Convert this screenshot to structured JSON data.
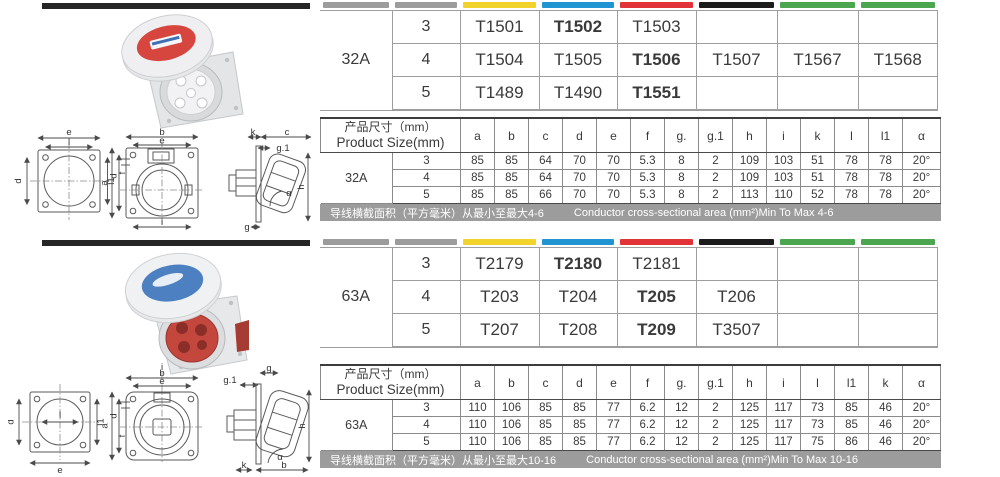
{
  "colors": {
    "divider_bar": "#262626",
    "strip_gray": "#9C9C9C",
    "strip_yellow": "#F2D32B",
    "strip_blue": "#2095D2",
    "strip_red": "#E23438",
    "strip_black": "#1C1C1C",
    "strip_green": "#4CA64F",
    "note_bar_bg": "#9C9C9C",
    "photo_top_cap": "#D7463E",
    "photo_bottom_cap": "#4C80C1",
    "photo_bottom_face": "#C4473E"
  },
  "sections": [
    {
      "rating": "32A",
      "model_table": {
        "strip_colors": [
          "#9C9C9C",
          "#9C9C9C",
          "#F2D32B",
          "#2095D2",
          "#E23438",
          "#1C1C1C",
          "#4CA64F",
          "#4CA64F"
        ],
        "rows": [
          {
            "poles": "3",
            "models": [
              "T1501",
              "T1502",
              "T1503",
              "",
              "",
              ""
            ]
          },
          {
            "poles": "4",
            "models": [
              "T1504",
              "T1505",
              "T1506",
              "T1507",
              "T1567",
              "T1568"
            ]
          },
          {
            "poles": "5",
            "models": [
              "T1489",
              "T1490",
              "T1551",
              "",
              "",
              ""
            ]
          }
        ]
      },
      "size_table": {
        "title_cn": "产品尺寸（mm）",
        "title_en": "Product Size(mm)",
        "columns": [
          "a",
          "b",
          "c",
          "d",
          "e",
          "f",
          "g.",
          "g.1",
          "h",
          "i",
          "k",
          "l",
          "l1",
          "α"
        ],
        "rows": [
          {
            "poles": "3",
            "values": [
              "85",
              "85",
              "64",
              "70",
              "70",
              "5.3",
              "8",
              "2",
              "109",
              "103",
              "51",
              "78",
              "78",
              "20°"
            ]
          },
          {
            "poles": "4",
            "values": [
              "85",
              "85",
              "64",
              "70",
              "70",
              "5.3",
              "8",
              "2",
              "109",
              "103",
              "51",
              "78",
              "78",
              "20°"
            ]
          },
          {
            "poles": "5",
            "values": [
              "85",
              "85",
              "66",
              "70",
              "70",
              "5.3",
              "8",
              "2",
              "113",
              "110",
              "52",
              "78",
              "78",
              "20°"
            ]
          }
        ]
      },
      "note_cn": "导线横截面积（平方毫米）从最小至最大4-6",
      "note_en": "Conductor cross-sectional area (mm²)Min To Max 4-6"
    },
    {
      "rating": "63A",
      "model_table": {
        "strip_colors": [
          "#9C9C9C",
          "#9C9C9C",
          "#F2D32B",
          "#2095D2",
          "#E23438",
          "#1C1C1C",
          "#4CA64F",
          "#4CA64F"
        ],
        "rows": [
          {
            "poles": "3",
            "models": [
              "T2179",
              "T2180",
              "T2181",
              "",
              "",
              ""
            ]
          },
          {
            "poles": "4",
            "models": [
              "T203",
              "T204",
              "T205",
              "T206",
              "",
              ""
            ]
          },
          {
            "poles": "5",
            "models": [
              "T207",
              "T208",
              "T209",
              "T3507",
              "",
              ""
            ]
          }
        ]
      },
      "size_table": {
        "title_cn": "产品尺寸（mm）",
        "title_en": "Product Size(mm)",
        "columns": [
          "a",
          "b",
          "c",
          "d",
          "e",
          "f",
          "g.",
          "g.1",
          "h",
          "i",
          "l",
          "l1",
          "k",
          "α"
        ],
        "rows": [
          {
            "poles": "3",
            "values": [
              "110",
              "106",
              "85",
              "85",
              "77",
              "6.2",
              "12",
              "2",
              "125",
              "117",
              "73",
              "85",
              "46",
              "20°"
            ]
          },
          {
            "poles": "4",
            "values": [
              "110",
              "106",
              "85",
              "85",
              "77",
              "6.2",
              "12",
              "2",
              "125",
              "117",
              "73",
              "85",
              "46",
              "20°"
            ]
          },
          {
            "poles": "5",
            "values": [
              "110",
              "106",
              "85",
              "85",
              "77",
              "6.2",
              "12",
              "2",
              "125",
              "117",
              "75",
              "86",
              "46",
              "20°"
            ]
          }
        ]
      },
      "note_cn": "导线横截面积（平方毫米）从最小至最大10-16",
      "note_en": "Conductor cross-sectional area (mm²)Min To Max 10-16"
    }
  ],
  "drawings": {
    "top": {
      "view1": {
        "top_outer": "e",
        "top_inner": "l",
        "left": "d",
        "right": "l1"
      },
      "view2": {
        "top_outer": "b",
        "top_inner": "e",
        "left_outer": "a",
        "left_inner": "d",
        "small": "f",
        "bottom": "i"
      },
      "view3": {
        "top_left": "k",
        "top_right": "c",
        "g1": "g.1",
        "right": "h",
        "angle": "α",
        "bottom": "g"
      }
    },
    "bottom": {
      "view1": {
        "left": "d",
        "center": "l",
        "right": "l1",
        "bottom": "e"
      },
      "view2": {
        "top_center": "i",
        "top_outer": "b",
        "top_inner": "e",
        "left_outer": "a",
        "left_inner": "d",
        "small": "f"
      },
      "view3": {
        "top": "g",
        "g1": "g.1",
        "right": "h",
        "angle": "α",
        "bottom": "b",
        "bottom_left": "k"
      }
    }
  }
}
